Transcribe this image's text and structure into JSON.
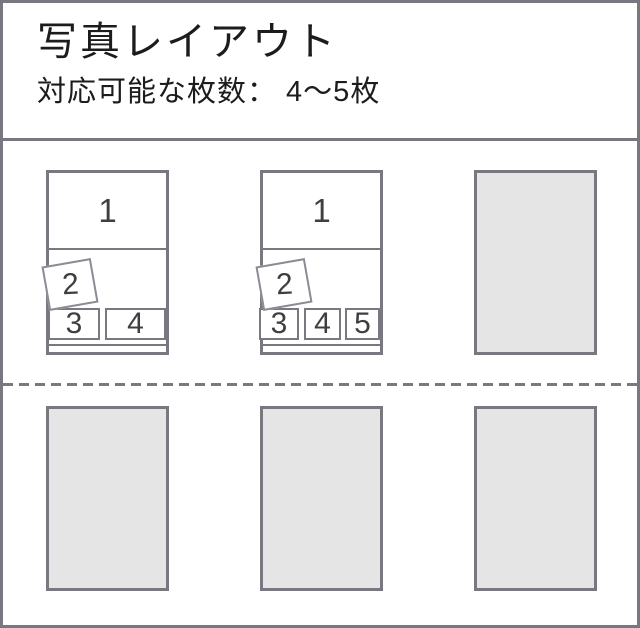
{
  "header": {
    "title": "写真レイアウト",
    "subtitle": "対応可能な枚数： 4～5枚"
  },
  "layouts": [
    {
      "cells": [
        "1",
        "2",
        "3",
        "4"
      ]
    },
    {
      "cells": [
        "1",
        "2",
        "3",
        "4",
        "5"
      ]
    }
  ],
  "placeholder_count": 4,
  "colors": {
    "frame_border": "#7a7780",
    "placeholder_fill": "#e5e5e6",
    "digit": "#3f3f3f",
    "text": "#1c1c1c"
  }
}
